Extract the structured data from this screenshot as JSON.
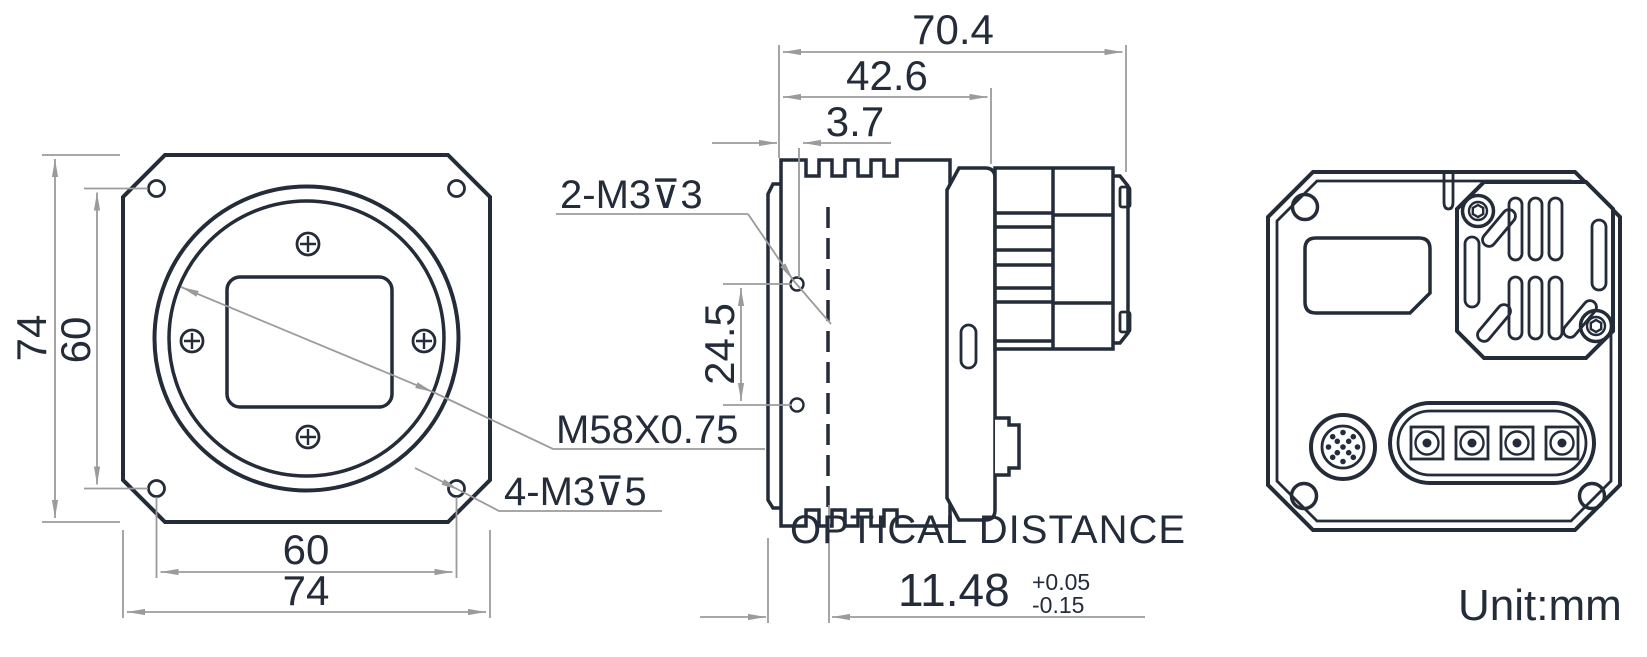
{
  "drawing": {
    "unit_label": "Unit:mm",
    "colors": {
      "line": "#242c39",
      "dim_line": "#9b9b9b",
      "background": "#ffffff"
    },
    "front_view": {
      "dim_height_outer": "74",
      "dim_height_holes": "60",
      "dim_width_holes": "60",
      "dim_width_outer": "74",
      "label_mount_thread": "M58X0.75",
      "label_corner_holes": "4-M3⊽5"
    },
    "side_view": {
      "dim_overall_depth": "70.4",
      "dim_body_depth": "42.6",
      "dim_flange_offset": "3.7",
      "dim_side_hole_spacing": "24.5",
      "label_side_holes": "2-M3⊽3",
      "optical_title": "OPTICAL DISTANCE",
      "optical_value": "11.48",
      "optical_tol_plus": "+0.05",
      "optical_tol_minus": "-0.15"
    }
  }
}
